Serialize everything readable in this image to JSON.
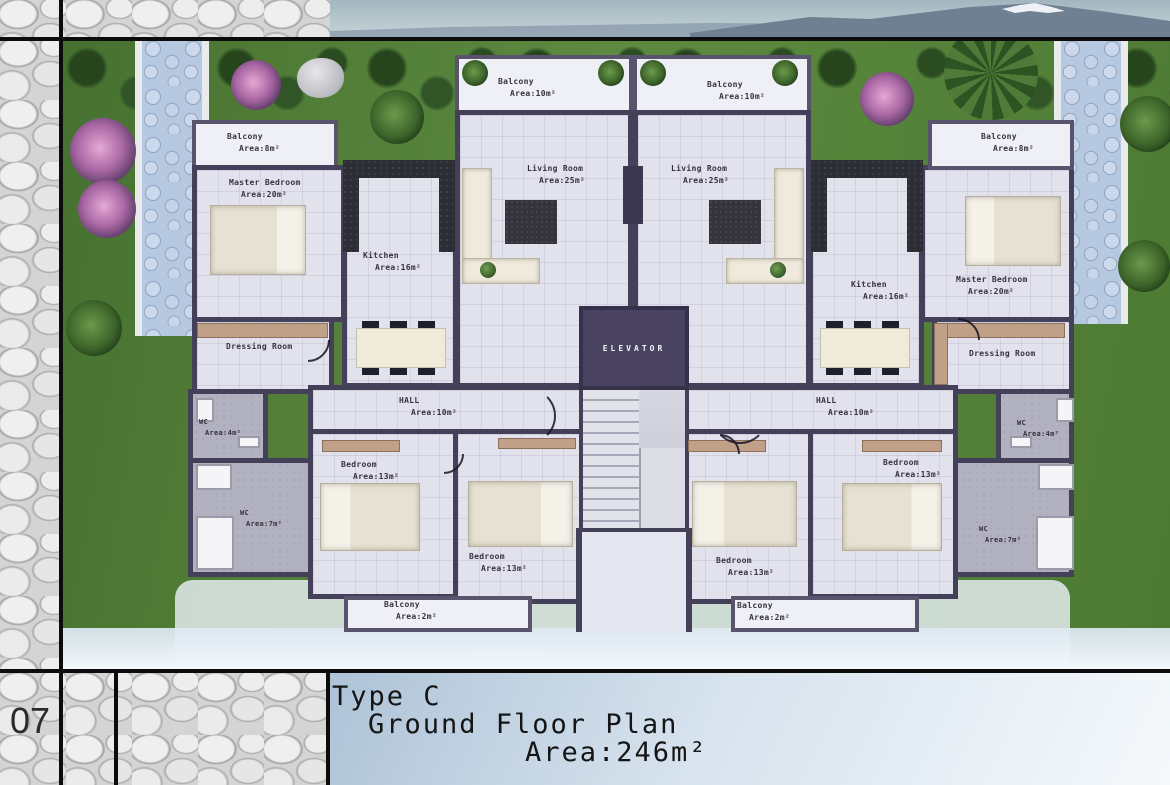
{
  "sheet": {
    "number": "07"
  },
  "title_block": {
    "type_label": "Type C",
    "floor_label": "Ground Floor Plan",
    "area_label": "Area:246m²"
  },
  "core": {
    "elevator": "ELEVATOR"
  },
  "apartment_left": {
    "balcony_top": {
      "name": "Balcony",
      "area": "Area:10m²"
    },
    "living_room": {
      "name": "Living Room",
      "area": "Area:25m²"
    },
    "kitchen": {
      "name": "Kitchen",
      "area": "Area:16m²"
    },
    "master_bedroom": {
      "name": "Master Bedroom",
      "area": "Area:20m²"
    },
    "balcony_side": {
      "name": "Balcony",
      "area": "Area:8m²"
    },
    "dressing_room": {
      "name": "Dressing Room"
    },
    "wc_small": {
      "name": "WC",
      "area": "Area:4m²"
    },
    "wc_large": {
      "name": "WC",
      "area": "Area:7m²"
    },
    "hall": {
      "name": "HALL",
      "area": "Area:10m²"
    },
    "bedroom_a": {
      "name": "Bedroom",
      "area": "Area:13m²"
    },
    "bedroom_b": {
      "name": "Bedroom",
      "area": "Area:13m²"
    },
    "balcony_bottom": {
      "name": "Balcony",
      "area": "Area:2m²"
    }
  },
  "apartment_right": {
    "balcony_top": {
      "name": "Balcony",
      "area": "Area:10m²"
    },
    "living_room": {
      "name": "Living Room",
      "area": "Area:25m²"
    },
    "kitchen": {
      "name": "Kitchen",
      "area": "Area:16m²"
    },
    "master_bedroom": {
      "name": "Master Bedroom",
      "area": "Area:20m²"
    },
    "balcony_side": {
      "name": "Balcony",
      "area": "Area:8m²"
    },
    "dressing_room": {
      "name": "Dressing Room"
    },
    "wc_small": {
      "name": "WC",
      "area": "Area:4m²"
    },
    "wc_large": {
      "name": "WC",
      "area": "Area:7m²"
    },
    "hall": {
      "name": "HALL",
      "area": "Area:10m²"
    },
    "bedroom_a": {
      "name": "Bedroom",
      "area": "Area:13m²"
    },
    "bedroom_b": {
      "name": "Bedroom",
      "area": "Area:13m²"
    },
    "balcony_bottom": {
      "name": "Balcony",
      "area": "Area:2m²"
    }
  },
  "colors": {
    "wall": "#45405a",
    "floor": "#e2e2ec",
    "wet_floor": "#b1b1c0",
    "wood": "#c0a086",
    "grass": "#4e7a35",
    "path": "#b7c8e1",
    "sky_panel": "#aec3d7",
    "frame_stone": "#d4d4d4"
  }
}
